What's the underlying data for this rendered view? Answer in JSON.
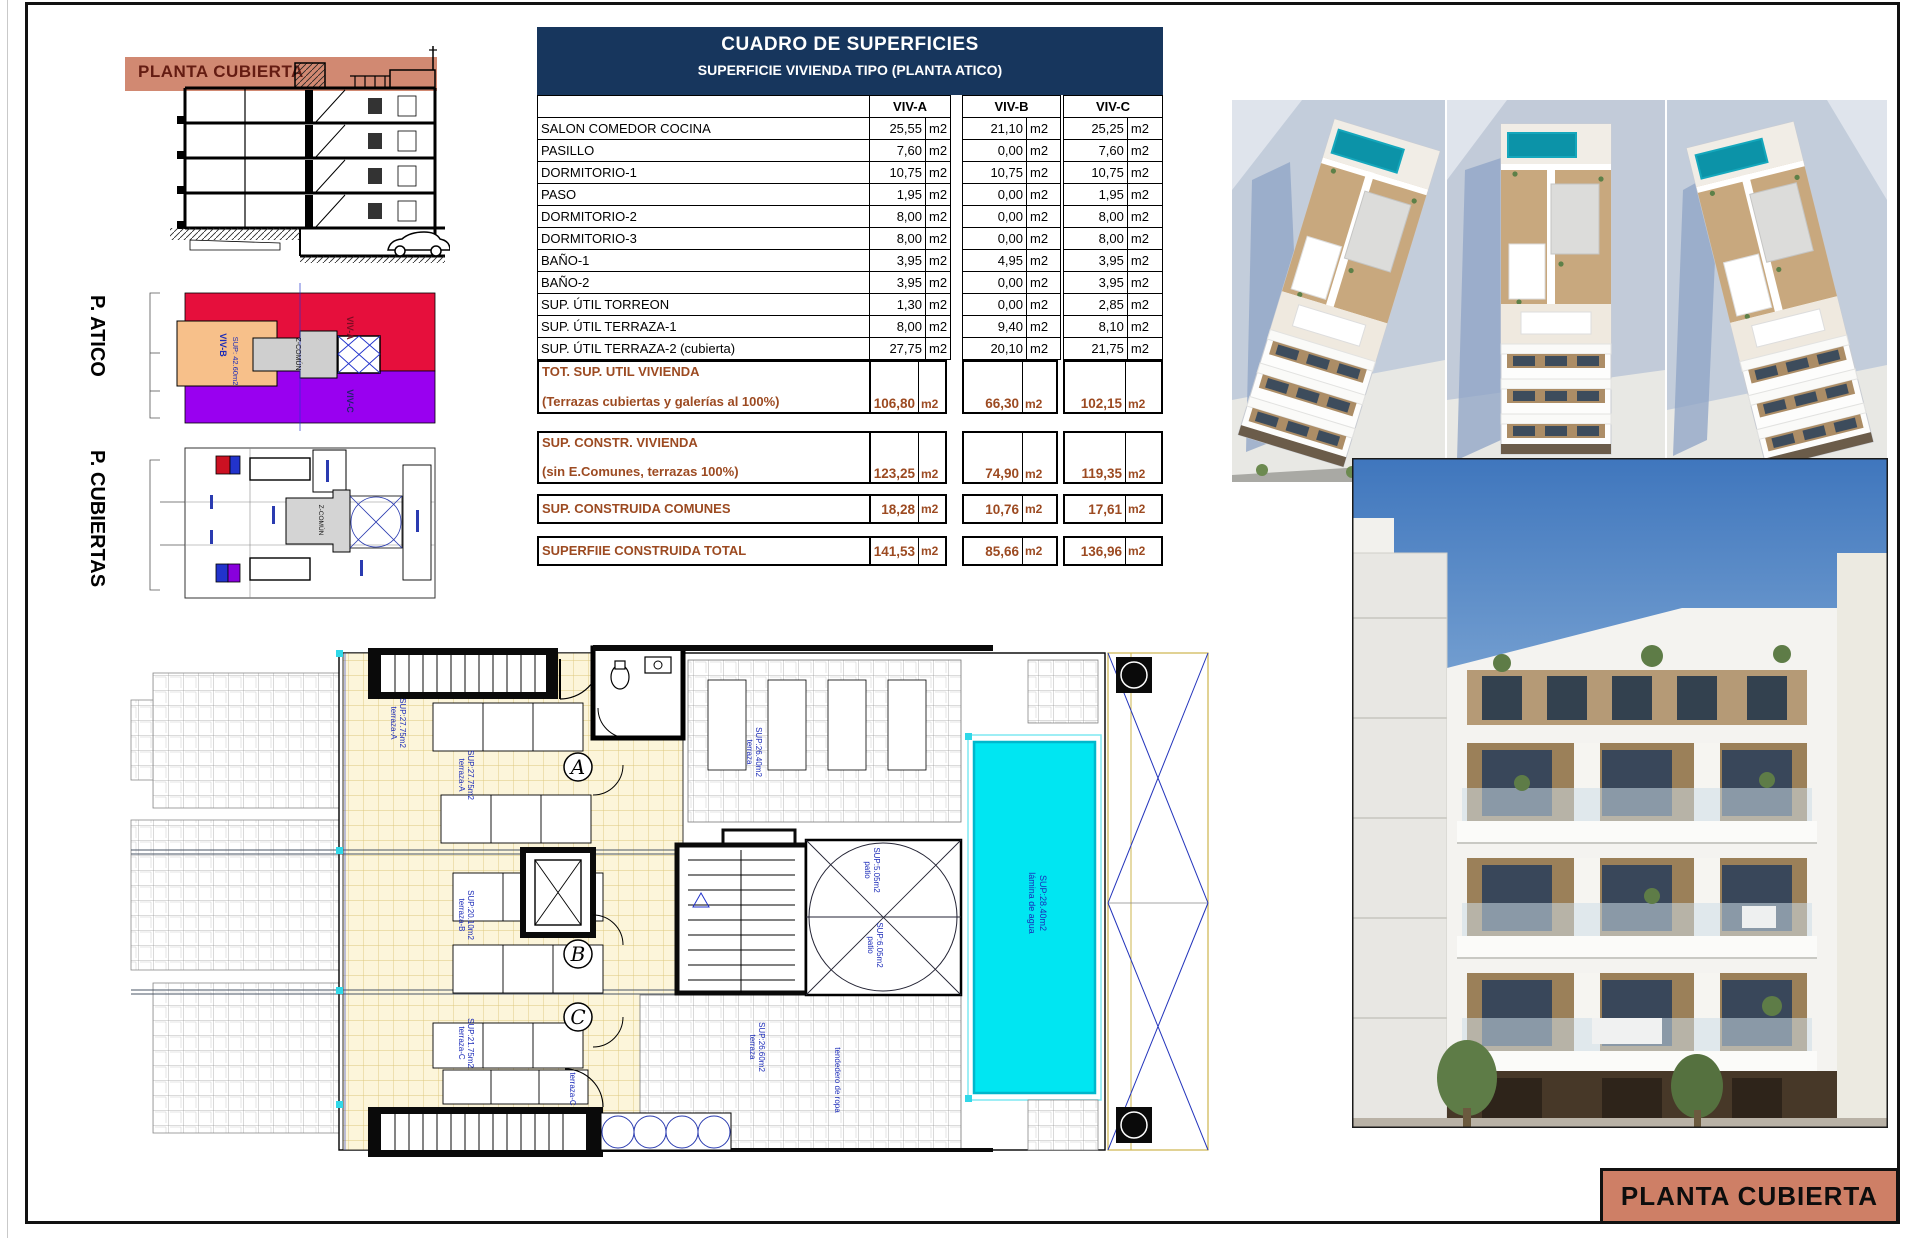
{
  "sheet": {
    "title_block": "PLANTA CUBIERTA"
  },
  "section": {
    "band_label": "PLANTA CUBIERTA"
  },
  "atico_plan": {
    "title": "P. ATICO",
    "viv_a": "VIV-A",
    "viv_b": "VIV-B",
    "viv_b_sup": "SUP: 42.60m2",
    "viv_c": "VIV-C",
    "zcomun": "Z-COMÚN"
  },
  "cubiertas_plan": {
    "title": "P. CUBIERTAS",
    "zcomun": "Z-COMÚN"
  },
  "table": {
    "title": "CUADRO DE SUPERFICIES",
    "subtitle": "SUPERFICIE VIVIENDA TIPO  (PLANTA ATICO)",
    "columns": [
      "VIV-A",
      "VIV-B",
      "VIV-C"
    ],
    "unit": "m2",
    "rows": [
      {
        "label": "SALON COMEDOR COCINA",
        "values": [
          "25,55",
          "21,10",
          "25,25"
        ]
      },
      {
        "label": "PASILLO",
        "values": [
          "7,60",
          "0,00",
          "7,60"
        ]
      },
      {
        "label": "DORMITORIO-1",
        "values": [
          "10,75",
          "10,75",
          "10,75"
        ]
      },
      {
        "label": "PASO",
        "values": [
          "1,95",
          "0,00",
          "1,95"
        ]
      },
      {
        "label": "DORMITORIO-2",
        "values": [
          "8,00",
          "0,00",
          "8,00"
        ]
      },
      {
        "label": "DORMITORIO-3",
        "values": [
          "8,00",
          "0,00",
          "8,00"
        ]
      },
      {
        "label": "BAÑO-1",
        "values": [
          "3,95",
          "4,95",
          "3,95"
        ]
      },
      {
        "label": "BAÑO-2",
        "values": [
          "3,95",
          "0,00",
          "3,95"
        ]
      },
      {
        "label": "SUP. ÚTIL TORREON",
        "values": [
          "1,30",
          "0,00",
          "2,85"
        ]
      },
      {
        "label": "SUP. ÚTIL TERRAZA-1",
        "values": [
          "8,00",
          "9,40",
          "8,10"
        ]
      },
      {
        "label": "SUP. ÚTIL TERRAZA-2 (cubierta)",
        "values": [
          "27,75",
          "20,10",
          "21,75"
        ]
      }
    ],
    "totals": [
      {
        "label_line1": "TOT. SUP. UTIL VIVIENDA",
        "label_line2": "(Terrazas cubiertas y galerías al 100%)",
        "values": [
          "106,80",
          "66,30",
          "102,15"
        ]
      },
      {
        "label_line1": "SUP. CONSTR. VIVIENDA",
        "label_line2": "(sin E.Comunes, terrazas 100%)",
        "values": [
          "123,25",
          "74,90",
          "119,35"
        ]
      },
      {
        "label_line1": "SUP. CONSTRUIDA COMUNES",
        "label_line2": "",
        "values": [
          "18,28",
          "10,76",
          "17,61"
        ]
      },
      {
        "label_line1": "SUPERFIIE CONSTRUIDA TOTAL",
        "label_line2": "",
        "values": [
          "141,53",
          "85,66",
          "136,96"
        ]
      }
    ]
  },
  "plan": {
    "terraza_a": "terraza-A",
    "terraza_a_sup": "SUP:27.75m2",
    "terraza_a2": "terraza-A",
    "terraza_a2_sup": "SUP:27.75m2",
    "terraza_b": "terraza-B",
    "terraza_b_sup": "SUP:20.10m2",
    "terraza_c": "terraza-C",
    "terraza_c_sup": "SUP:21.75m2",
    "terraza_c2": "terraza-C",
    "terraza_c2_sup": "SUP:21.75m2",
    "gray_top": "terraza",
    "gray_top_sup": "SUP:26.40m2",
    "gray_bottom": "terraza",
    "gray_bottom_sup": "SUP:26.60m2",
    "tendedero": "tendedero de ropa",
    "patio_top": "patio",
    "patio_top_sup": "SUP:5.05m2",
    "patio_bottom": "patio",
    "patio_bottom_sup": "SUP:6.05m2",
    "pool_line1": "lámina de agua",
    "pool_line2": "SUP:28.40m2",
    "letters": {
      "a": "A",
      "b": "B",
      "c": "C"
    }
  },
  "colors": {
    "header_navy": "#17365d",
    "totals_rust": "#9c4a21",
    "band_salmon": "#cd7f66",
    "pool_cyan": "#00e6f2",
    "atico_red": "#e60f3c",
    "atico_orange": "#f7c08a",
    "atico_purple": "#9900f0",
    "plan_label_blue": "#1b2bb8"
  }
}
